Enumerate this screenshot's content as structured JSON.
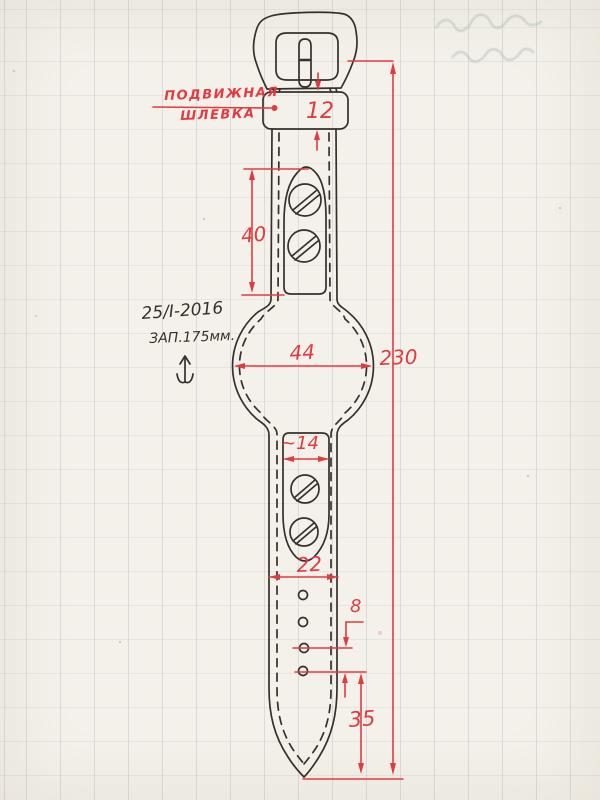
{
  "colors": {
    "paper": "#f4f1ea",
    "gridv": "rgba(150,162,178,0.28)",
    "gridh": "rgba(150,162,178,0.15)",
    "ink": "#35302b",
    "red": "#e13b40",
    "ghost": "#aebcb2"
  },
  "labels": {
    "keeper_line1": "ПОДВИЖНАЯ",
    "keeper_line2": "ШЛЁВКА",
    "note_date": "25/I-2016",
    "note_stock": "ЗАП.175мм."
  },
  "dimensions": {
    "keeper_width": "12",
    "upper_pad_length": "40",
    "case_width": "44",
    "total_length": "230",
    "slot_width": "~14",
    "strap_width": "22",
    "hole_pitch": "8",
    "tip_to_last_hole": "35"
  }
}
